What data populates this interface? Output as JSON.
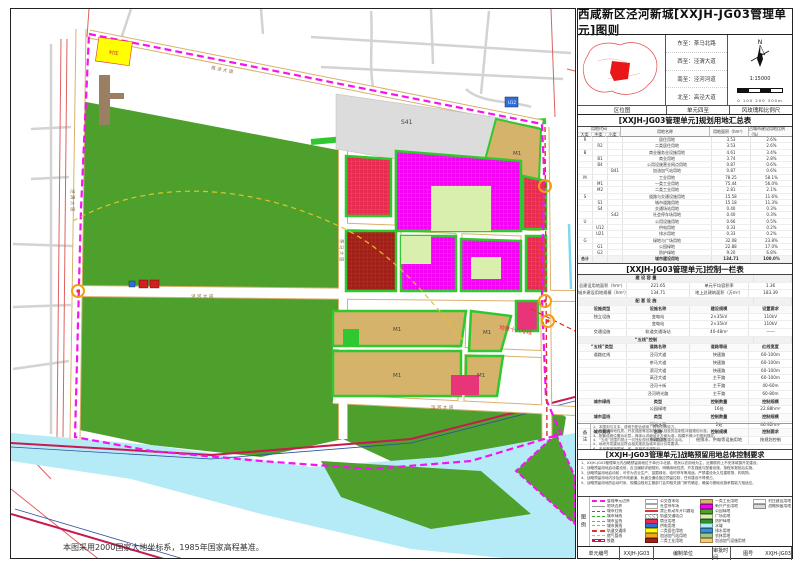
{
  "title": "西咸新区泾河新城[XXJH-JG03管理单元]图则",
  "location": {
    "bounds": {
      "east": "东至：茶马北路",
      "west": "西至：泾渭大道",
      "south": "南至：泾河河道",
      "north": "北至：高泾大道"
    },
    "captions": [
      "区位图",
      "单元四至",
      "风玫瑰和比例尺"
    ],
    "north_mark": "N",
    "scale": "1:15000",
    "scale_ticks": "0   100   200   300m"
  },
  "landuse": {
    "title": "[XXJH-JG03管理单元]规划用地汇总表",
    "head": {
      "code": "用地代码",
      "major": "大类",
      "mid": "中类",
      "minor": "小类",
      "name": "用地名称",
      "area": "用地面积（hm²）",
      "pct": "占城市建设用地比例（%）"
    },
    "rows": [
      {
        "a": "R",
        "b": "",
        "c": "",
        "n": "居住用地",
        "ar": "3.53",
        "p": "2.6%"
      },
      {
        "a": "",
        "b": "R2",
        "c": "",
        "n": "二类居住用地",
        "ar": "3.53",
        "p": "2.6%"
      },
      {
        "a": "B",
        "b": "",
        "c": "",
        "n": "商业服务业设施用地",
        "ar": "4.61",
        "p": "3.4%"
      },
      {
        "a": "",
        "b": "B1",
        "c": "",
        "n": "商业用地",
        "ar": "3.74",
        "p": "2.8%"
      },
      {
        "a": "",
        "b": "B4",
        "c": "",
        "n": "公用设施营业网点用地",
        "ar": "0.87",
        "p": "0.6%"
      },
      {
        "a": "",
        "b": "",
        "c": "B41",
        "n": "加油加气站用地",
        "ar": "0.87",
        "p": "0.6%"
      },
      {
        "a": "M",
        "b": "",
        "c": "",
        "n": "工业用地",
        "ar": "78.25",
        "p": "58.1%"
      },
      {
        "a": "",
        "b": "M1",
        "c": "",
        "n": "一类工业用地",
        "ar": "75.44",
        "p": "56.0%"
      },
      {
        "a": "",
        "b": "M2",
        "c": "",
        "n": "二类工业用地",
        "ar": "2.81",
        "p": "2.1%"
      },
      {
        "a": "S",
        "b": "",
        "c": "",
        "n": "道路与交通设施用地",
        "ar": "15.58",
        "p": "11.6%"
      },
      {
        "a": "",
        "b": "S1",
        "c": "",
        "n": "城市道路用地",
        "ar": "15.18",
        "p": "11.3%"
      },
      {
        "a": "",
        "b": "S4",
        "c": "",
        "n": "交通场站用地",
        "ar": "0.40",
        "p": "0.3%"
      },
      {
        "a": "",
        "b": "",
        "c": "S42",
        "n": "社会停车场用地",
        "ar": "0.40",
        "p": "0.3%"
      },
      {
        "a": "U",
        "b": "",
        "c": "",
        "n": "公用设施用地",
        "ar": "0.66",
        "p": "0.5%"
      },
      {
        "a": "",
        "b": "U12",
        "c": "",
        "n": "供电用地",
        "ar": "0.33",
        "p": "0.2%"
      },
      {
        "a": "",
        "b": "U21",
        "c": "",
        "n": "排水用地",
        "ar": "0.33",
        "p": "0.2%"
      },
      {
        "a": "G",
        "b": "",
        "c": "",
        "n": "绿地与广场用地",
        "ar": "32.08",
        "p": "23.8%"
      },
      {
        "a": "",
        "b": "G1",
        "c": "",
        "n": "公园绿地",
        "ar": "22.88",
        "p": "17.0%"
      },
      {
        "a": "",
        "b": "G2",
        "c": "",
        "n": "防护绿地",
        "ar": "9.20",
        "p": "6.8%"
      },
      {
        "a": "合计",
        "b": "",
        "c": "",
        "n": "城市建设用地",
        "ar": "134.71",
        "p": "100.0%",
        "cls": "tot"
      },
      {
        "a": "",
        "b": "",
        "c": "",
        "n": "战略预留用地",
        "ar": "19.00",
        "p": "—"
      },
      {
        "a": "",
        "b": "",
        "c": "",
        "n": "非建设用地",
        "ar": "67.94",
        "p": "—",
        "cls": "tot"
      },
      {
        "a": "E",
        "b": "E1",
        "c": "",
        "n": "水域",
        "ar": "67.94",
        "p": "—"
      },
      {
        "a": "总计",
        "b": "",
        "c": "",
        "n": "规划总用地",
        "ar": "221.65",
        "p": "—",
        "cls": "tot"
      }
    ]
  },
  "control": {
    "title": "[XXJH-JG03管理单元]控制一栏表",
    "rows": [
      {
        "cls": "sec",
        "c1": "建 设 容 量"
      },
      {
        "c1": "总建设用地面积（hm²）",
        "c2": "221.65",
        "c3": "单元平均容积率",
        "c4": "1.36"
      },
      {
        "c1": "城乡建设用地规模（hm²）",
        "c2": "134.71",
        "c3": "地上总建筑面积（万m²）",
        "c4": "183.39"
      },
      {
        "cls": "sec",
        "c1": "配 套 设 施"
      },
      {
        "cls": "hd",
        "c1": "设施类型",
        "c2": "设施名称",
        "c3": "建设规模",
        "c4": "设置要求"
      },
      {
        "c1": "独立设施",
        "c2": "变电站",
        "c3": "2×35kV",
        "c4": "110kV"
      },
      {
        "c1": "",
        "c2": "变电站",
        "c3": "2×35kV",
        "c4": "110kV"
      },
      {
        "c1": "交通设施",
        "c2": "轨道交通场站",
        "c3": "40-48m²",
        "c4": "——"
      },
      {
        "cls": "sec",
        "c1": "“五线”控制"
      },
      {
        "cls": "hd",
        "c1": "“五线”类型",
        "c2": "道路名称",
        "c3": "道路等级",
        "c4": "红线宽度"
      },
      {
        "c1": "道路红线",
        "c2": "泾河大道",
        "c3": "快速路",
        "c4": "60-100m"
      },
      {
        "c1": "",
        "c2": "茶马大道",
        "c3": "快速路",
        "c4": "60-100m"
      },
      {
        "c1": "",
        "c2": "滨河大道",
        "c3": "快速路",
        "c4": "60-100m"
      },
      {
        "c1": "",
        "c2": "高泾大道",
        "c3": "主干路",
        "c4": "60-100m"
      },
      {
        "c1": "",
        "c2": "泾河十街",
        "c3": "主干路",
        "c4": "40-60m"
      },
      {
        "c1": "",
        "c2": "泾河明光路",
        "c3": "主干路",
        "c4": "60-80m"
      },
      {
        "cls": "hd",
        "c1": "城市绿线",
        "c2": "类型",
        "c3": "控制数量",
        "c4": "控制规模"
      },
      {
        "c1": "",
        "c2": "公园绿地",
        "c3": "16处",
        "c4": "22.88hm²"
      },
      {
        "cls": "hd",
        "c1": "城市蓝线",
        "c2": "类型",
        "c3": "控制数量",
        "c4": "控制规模"
      },
      {
        "c1": "",
        "c2": "河湖水系",
        "c3": "2处",
        "c4": "46.92hm²"
      },
      {
        "cls": "hd",
        "c1": "城市黄线",
        "c2": "名称",
        "c3": "控制规模",
        "c4": "控制要求"
      },
      {
        "c1": "",
        "c2": "市政设施",
        "c3": "给排水、供电等设施用地",
        "c4": "按规划控制"
      }
    ]
  },
  "notes": {
    "label": "备注",
    "items": [
      "1、本图则与文本、说明书配合使用，具有同等效力。",
      "2、各地块用地性质、开发强度等控制指标以批准的控制性详细规划为准。",
      "3、配套设施位置为示意，具体以详细设计方案为准，规模不得小于图则规定。",
      "4、“五线”范围内禁止一切违反规划控制要求的建设活动。",
      "5、地块开发建设应符合相关规范及城市设计引导要求。",
      "6、未尽事宜按国家、省、市相关法规执行。"
    ]
  },
  "strategic": {
    "title": "[XXJH-JG03管理单元]战略预留用地总体控制要求",
    "paras": [
      "1、XXJH-JG03管理单元内战略预留用地位于单元中北部，现状以农用地为主，近期原则上不安排城镇开发建设。",
      "2、战略预留用地启动建设前，应当编制详细规划，明确用地性质、开发强度与配套设施，按程序报批后实施。",
      "3、战略预留用地启动前，可作为农业生产、苗圃绿化、临时停车等用途，严禁建设永久性建筑物、构筑物。",
      "4、战略预留用地内涉及的市政廊道、轨道交通设施应预留控制，任何建设不得侵占。",
      "5、战略预留用地的启动时序、规模由规划主管部门会同相关部门研究确定，确保与基础设施承载能力相适应。"
    ]
  },
  "legend": {
    "label": "图例",
    "col1": [
      {
        "sw": "sw-ln-unit",
        "label": "管理单元边界"
      },
      {
        "sw": "sw-ln-parcel",
        "label": "地块边界"
      },
      {
        "sw": "sw-ln-red",
        "label": "城市红线"
      },
      {
        "sw": "sw-ln-green",
        "label": "城市绿线"
      },
      {
        "sw": "sw-ln-blue",
        "label": "城市蓝线"
      },
      {
        "sw": "sw-ln-yellow",
        "label": "城市黄线"
      },
      {
        "sw": "sw-ln-metro",
        "label": "轨道交通线"
      },
      {
        "sw": "sw-ln-gas",
        "label": "燃气管线"
      },
      {
        "sw": "sw-ln-rail",
        "label": "铁路"
      }
    ],
    "col2": [
      {
        "sw": "sw-outline",
        "label": "公交首末站"
      },
      {
        "sw": "sw-p",
        "label": "社会停车场"
      },
      {
        "sw": "sw-stop",
        "label": "禁止机动车开口路段"
      },
      {
        "sw": "sw-hatch",
        "label": "轨道交通站点"
      },
      {
        "sw": "sw-red",
        "label": "商业用地"
      },
      {
        "sw": "sw-blue",
        "label": "供电用地"
      },
      {
        "sw": "sw-yellow",
        "label": "二类居住用地"
      },
      {
        "sw": "sw-orange",
        "label": "加油加气站用地"
      },
      {
        "sw": "sw-darkred",
        "label": "二类工业用地"
      }
    ],
    "col3": [
      {
        "sw": "sw-tan",
        "label": "一类工业用地"
      },
      {
        "sw": "sw-magenta",
        "label": "新兴产业用地"
      },
      {
        "sw": "sw-green",
        "label": "公园绿地"
      },
      {
        "sw": "sw-lgreen",
        "label": "广场用地"
      },
      {
        "sw": "sw-dgreen",
        "label": "防护绿地"
      },
      {
        "sw": "sw-cyan",
        "label": "水域"
      },
      {
        "sw": "sw-dblue",
        "label": "排水用地"
      },
      {
        "sw": "sw-pgreen",
        "label": "农林用地"
      },
      {
        "sw": "sw-cream",
        "label": "加油加气设施用地"
      }
    ],
    "col4": [
      {
        "sw": "sw-white",
        "label": "村庄建设用地"
      },
      {
        "sw": "sw-gray",
        "label": "战略预留用地"
      }
    ]
  },
  "footer": {
    "cells": [
      {
        "t": "单元编号"
      },
      {
        "t": "XXJH-JG03"
      },
      {
        "t": "编制单位"
      },
      {
        "t": "审批时间"
      },
      {
        "t": "图号"
      },
      {
        "t": "XXJH-JG03"
      }
    ]
  },
  "map": {
    "s41": "S41",
    "m1": "M1",
    "u12": "U12",
    "village": "村庄",
    "metro_label": "地铁十六号线",
    "datum_note": "本图采用2000国家大地坐标系，1985年国家高程基准。",
    "roads": {
      "gaojing": "高 泾 大 道",
      "jingwei": "泾 渭 大 道",
      "jinghe": "泾 河 大 道",
      "chama": "茶 马 大 道",
      "binhe": "滨 河 大 道"
    }
  }
}
